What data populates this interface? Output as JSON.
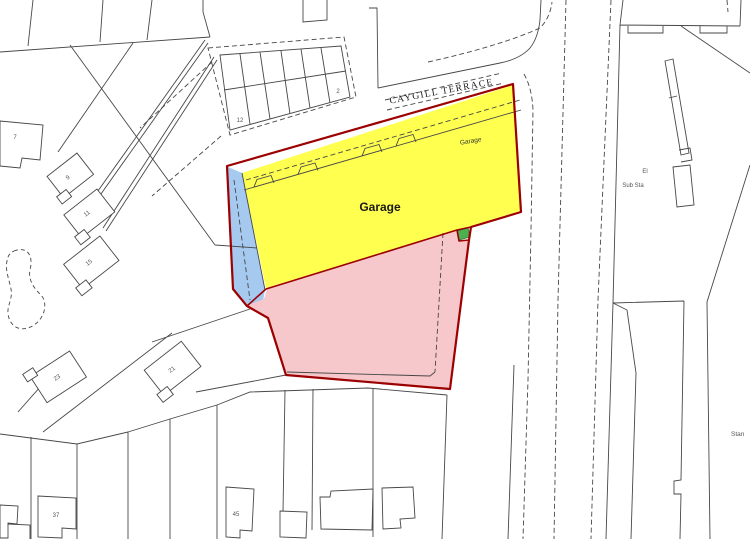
{
  "map": {
    "street_label": "CAYGILL TERRACE",
    "site": {
      "garage_main_label": "Garage",
      "garage_roof_label": "Garage"
    },
    "right_side": {
      "el": "El",
      "sub_sta": "Sub Sta",
      "stan_label": "Stan"
    },
    "house_numbers": [
      "7",
      "9",
      "11",
      "15",
      "21",
      "23",
      "37",
      "45"
    ],
    "garage_row_numbers": [
      "12",
      "2"
    ],
    "colors": {
      "site_yellow": "#FFFF4F",
      "site_pink": "#F6C7CB",
      "site_blue": "#A5C9EF",
      "site_green": "#4CAF50",
      "boundary_red": "#9C0000",
      "map_line": "#474747"
    }
  }
}
